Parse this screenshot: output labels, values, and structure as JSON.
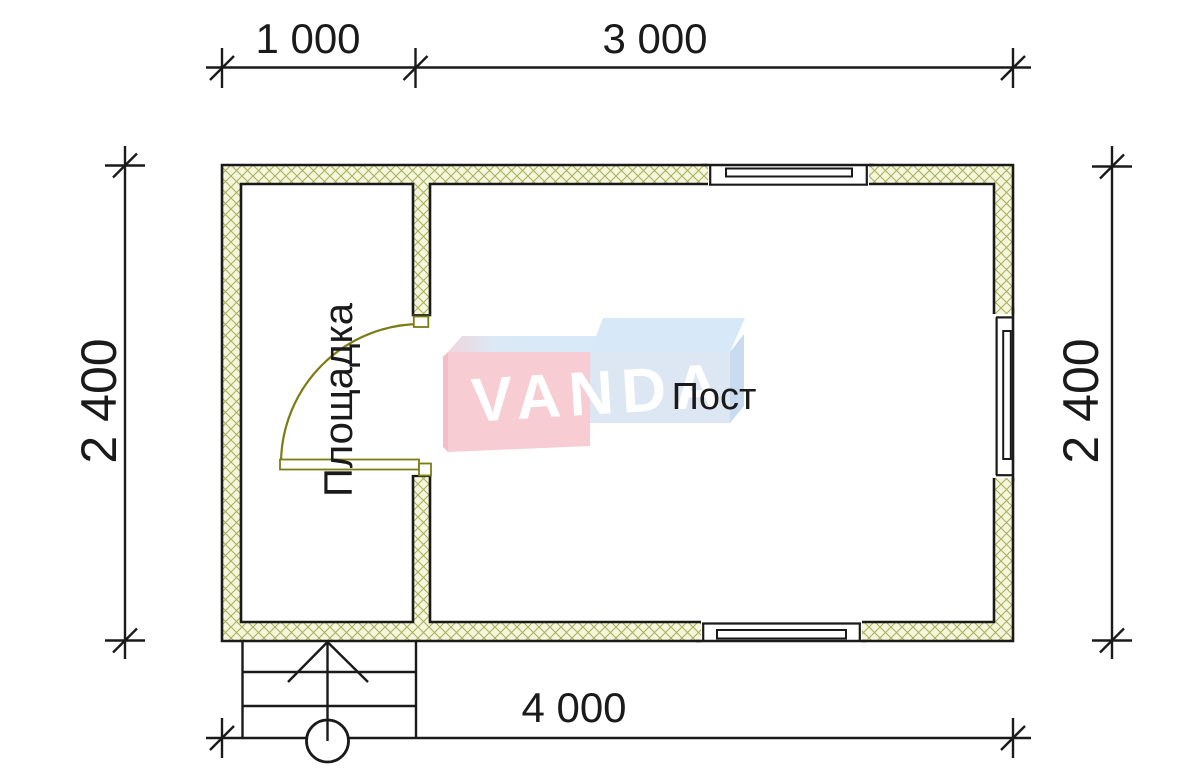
{
  "plan": {
    "type": "floor-plan",
    "dimensions": {
      "top_left": "1 000",
      "top_right": "3 000",
      "left": "2 400",
      "right": "2 400",
      "bottom": "4 000"
    },
    "rooms": {
      "left_label": "Площадка",
      "right_label": "Пост"
    },
    "watermark": {
      "brand": "VANDA"
    },
    "colors": {
      "line": "#1a1a1a",
      "wall_hatch_line": "#a9b05e",
      "wall_hatch_bg": "#f6f6dc",
      "door_olive": "#7c7c15",
      "logo_pink": "#f8ccd3",
      "logo_blue_front": "#dde7f3",
      "logo_blue_top": "#d7e9f8"
    }
  }
}
